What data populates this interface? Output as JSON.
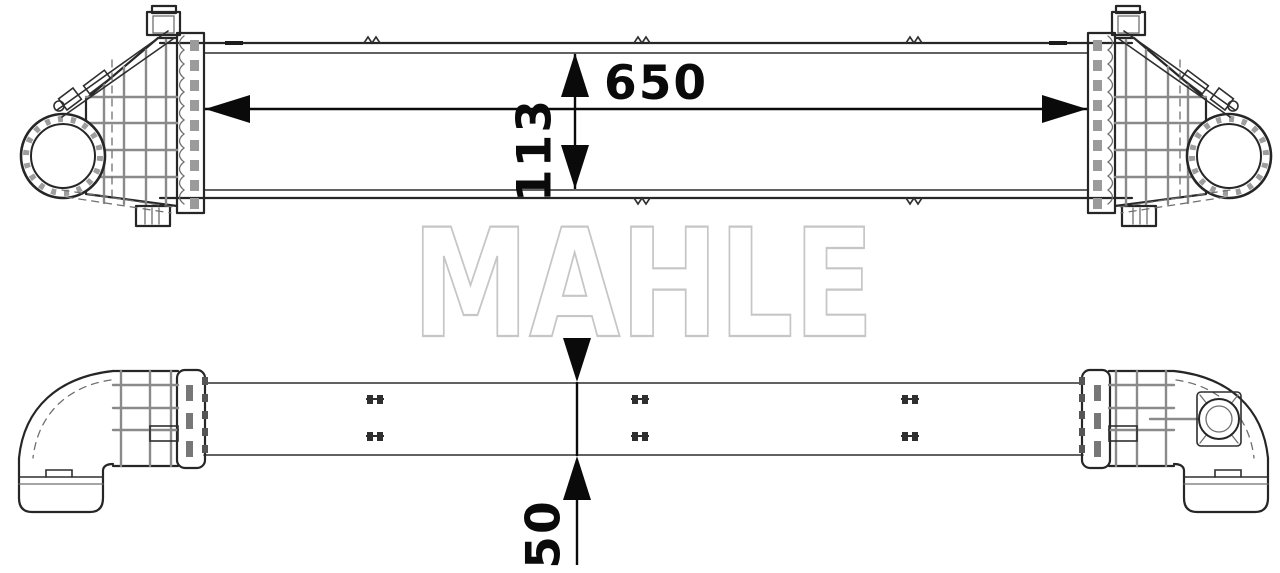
{
  "watermark": {
    "text": "MAHLE"
  },
  "dimensions": {
    "width": {
      "value": "650"
    },
    "height": {
      "value": "113"
    },
    "depth": {
      "value": "50"
    }
  },
  "colors": {
    "background": "#ffffff",
    "outline": "#262626",
    "detail_gray": "#8a8a8a",
    "dimension": "#0a0a0a",
    "watermark_stroke": "#c6c6c6"
  }
}
